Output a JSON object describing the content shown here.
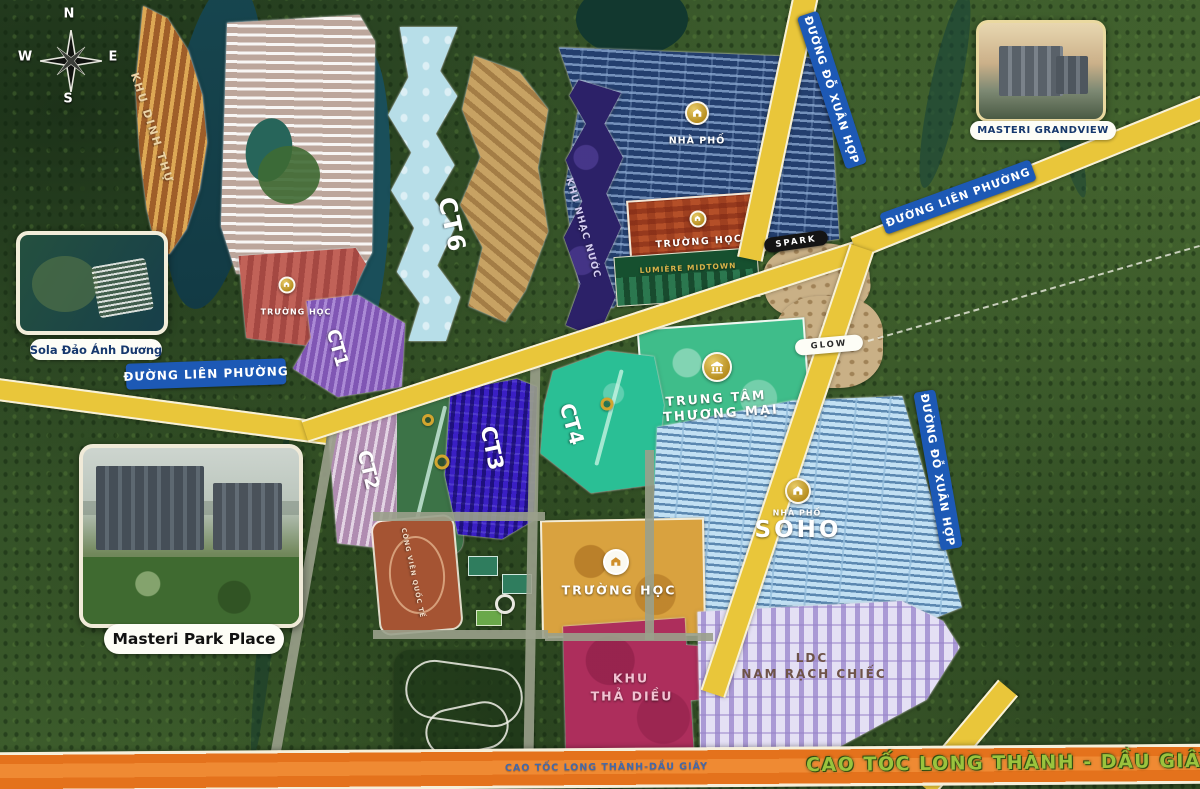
{
  "compass": {
    "n": "N",
    "e": "E",
    "s": "S",
    "w": "W"
  },
  "zones": {
    "khu_dinh_thu": "KHU DINH THỰ",
    "truong_hoc": "TRƯỜNG HỌC",
    "ct1": "CT1",
    "ct2": "CT2",
    "ct3": "CT3",
    "ct4": "CT4",
    "ct6": "CT6",
    "khu_nhac_nuoc": "KHU NHẠC NƯỚC",
    "nha_pho": "NHÀ PHỐ",
    "lumiere": "LUMIÈRE MIDTOWN",
    "spark": "SPARK",
    "glow": "GLOW",
    "trung_tam": {
      "line1": "TRUNG TÂM",
      "line2": "THƯƠNG MẠI"
    },
    "soho": "SOHO",
    "tha_dieu": {
      "line1": "KHU",
      "line2": "THẢ DIỀU"
    },
    "ldc": {
      "line1": "LDC",
      "line2": "NAM RẠCH CHIẾC"
    },
    "cong_vien": "CÔNG VIÊN QUỐC TẾ"
  },
  "roads": {
    "lien_phuong": "ĐƯỜNG LIÊN PHƯỜNG",
    "do_xuan_hop": "ĐƯỜNG ĐỖ XUÂN HỢP",
    "cao_toc_small": "CAO TỐC LONG THÀNH-DẦU GIÂY",
    "cao_toc_large": "CAO TỐC LONG THÀNH - DẦU GIÂY"
  },
  "insets": {
    "sola": "Sola Đảo Ánh Dương",
    "grandview": "MASTERI GRANDVIEW",
    "park_place": "Masteri Park Place"
  },
  "colors": {
    "road_yellow": "#e9c63a",
    "highway_orange": "#e4721c",
    "road_badge_blue": "#1d59b5",
    "forest_green": "#3a5629",
    "water_teal": "#16434e",
    "ct3_blue": "#3a1fc4",
    "ct4_teal": "#2abf95",
    "soho_blue": "#8fc6e8",
    "kite_crimson": "#ad2e5c",
    "ldc_lavender": "#b5a6dc",
    "mall_green": "#3fbd8a",
    "gold_icon": "#c9a227"
  }
}
